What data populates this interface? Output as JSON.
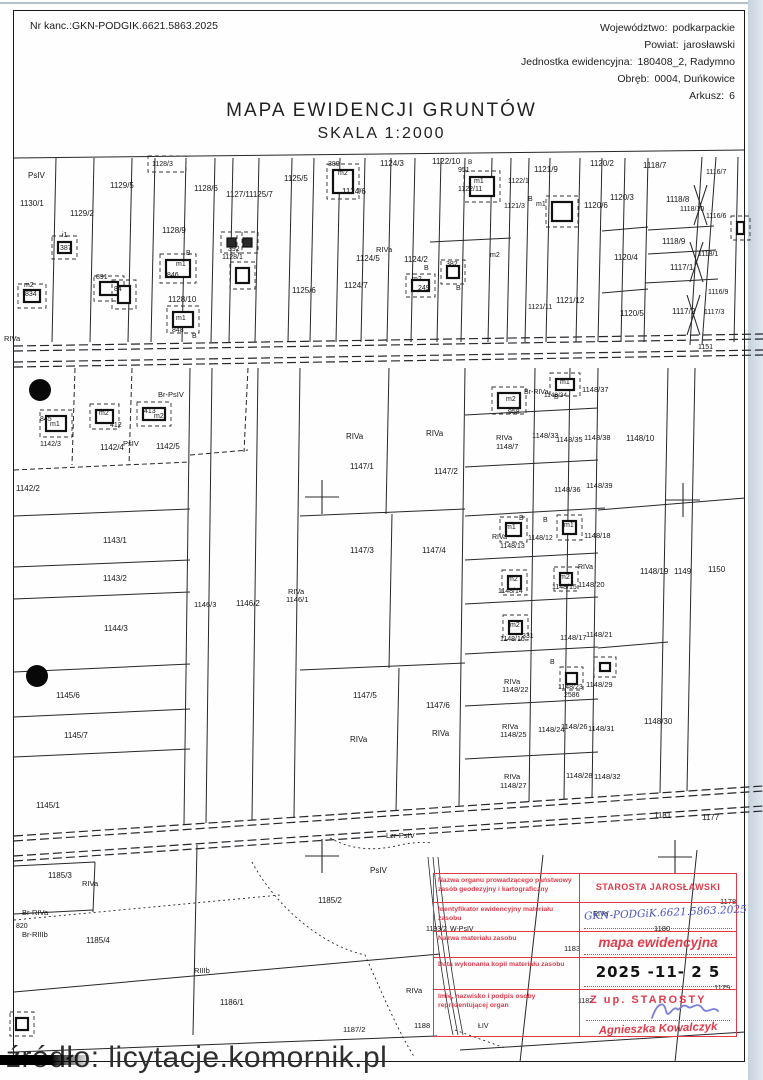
{
  "colors": {
    "stamp_red": "#e03a4a",
    "ink_blue": "#4a55c4",
    "map_black": "#1d1d1d",
    "scan_edge": "#c6d2dc"
  },
  "header": {
    "case_label": "Nr kanc.:",
    "case_number": "GKN-PODGIK.6621.5863.2025",
    "province_label": "Województwo:",
    "province": "podkarpackie",
    "county_label": "Powiat:",
    "county": "jarosławski",
    "unit_label": "Jednostka ewidencyjna:",
    "unit": "180408_2, Radymno",
    "district_label": "Obręb:",
    "district": "0004, Duńkowice",
    "sheet_label": "Arkusz:",
    "sheet": "6",
    "title": "MAPA EWIDENCJI GRUNTÓW",
    "scale": "SKALA 1:2000"
  },
  "stamp": {
    "field_labels": [
      "Nazwa organu prowadzącego państwowy zasób geodezyjny i kartograficzny",
      "Identyfikator ewidencyjny materiału zasobu",
      "Nazwa materiału zasobu",
      "Data wykonania kopii materiału zasobu",
      "Imię, nazwisko i podpis osoby reprezentującej organ"
    ],
    "authority": "STAROSTA JAROSŁAWSKI",
    "identifier_handwritten": "GKN-PODGiK.6621.5863.2025",
    "material_name": "mapa ewidencyjna",
    "copy_date": "2025 -11- 2 5",
    "signer_title": "Z up. STAROSTY",
    "signer_name": "Agnieszka Kowalczyk"
  },
  "watermark": {
    "text": "źródło: licytacje.komornik.pl"
  },
  "map": {
    "labels": [
      [
        "PsIV",
        28,
        178
      ],
      [
        "1130/1",
        20,
        206
      ],
      [
        "1129/5",
        110,
        188
      ],
      [
        "1129/2",
        70,
        216
      ],
      [
        "1128/3",
        152,
        166,
        7
      ],
      [
        "1128/6",
        194,
        191
      ],
      [
        "1127/1",
        226,
        197
      ],
      [
        "1125/7",
        249,
        197
      ],
      [
        "1125/5",
        284,
        181
      ],
      [
        "1128/9",
        162,
        233
      ],
      [
        "B",
        186,
        255,
        7
      ],
      [
        "m1",
        176,
        266,
        7
      ],
      [
        "846",
        167,
        277,
        7
      ],
      [
        "i1",
        62,
        237,
        7
      ],
      [
        "387",
        60,
        250,
        7
      ],
      [
        "891",
        96,
        279,
        7
      ],
      [
        "84",
        114,
        291,
        7
      ],
      [
        "m2",
        24,
        287,
        7
      ],
      [
        "834",
        25,
        296,
        7
      ],
      [
        "392",
        228,
        251,
        7
      ],
      [
        "1128/1",
        222,
        259,
        7
      ],
      [
        "1128/10",
        168,
        302
      ],
      [
        "m1",
        176,
        320,
        7
      ],
      [
        "848",
        172,
        332,
        7
      ],
      [
        "B",
        192,
        338,
        7
      ],
      [
        "RIVa",
        4,
        341,
        7.5
      ],
      [
        "389",
        328,
        166,
        7
      ],
      [
        "m2",
        338,
        175,
        7
      ],
      [
        "1124/3",
        380,
        166
      ],
      [
        "1124/6",
        342,
        194
      ],
      [
        "1122/10",
        432,
        164
      ],
      [
        "B",
        468,
        164,
        6.5
      ],
      [
        "951",
        458,
        172,
        7
      ],
      [
        "m1",
        474,
        183,
        7
      ],
      [
        "1122/11",
        458,
        191,
        7
      ],
      [
        "RIVa",
        376,
        252,
        7.5
      ],
      [
        "1124/5",
        356,
        261
      ],
      [
        "1124/2",
        404,
        262
      ],
      [
        "B",
        424,
        270,
        7
      ],
      [
        "m2",
        412,
        281,
        7
      ],
      [
        "249",
        418,
        290,
        7
      ],
      [
        "382",
        446,
        266,
        7
      ],
      [
        "B",
        456,
        290,
        7
      ],
      [
        "1125/6",
        292,
        293
      ],
      [
        "1124/7",
        344,
        288
      ],
      [
        "m2",
        490,
        257,
        7
      ],
      [
        "1121/9",
        534,
        172
      ],
      [
        "1122/1",
        508,
        183,
        7
      ],
      [
        "1121/3",
        504,
        208,
        7
      ],
      [
        "B",
        528,
        201,
        7
      ],
      [
        "m1",
        536,
        206,
        7
      ],
      [
        "1120/2",
        590,
        166
      ],
      [
        "1120/6",
        584,
        208
      ],
      [
        "1120/3",
        610,
        200
      ],
      [
        "1120/4",
        614,
        260
      ],
      [
        "1121/11",
        528,
        309,
        7
      ],
      [
        "1121/12",
        556,
        303
      ],
      [
        "1120/5",
        620,
        316
      ],
      [
        "1118/7",
        643,
        168
      ],
      [
        "1116/7",
        706,
        174,
        7
      ],
      [
        "1118/8",
        666,
        202
      ],
      [
        "1118/10",
        680,
        211,
        7
      ],
      [
        "1116/6",
        706,
        218,
        7
      ],
      [
        "1118/9",
        662,
        244
      ],
      [
        "1118/1",
        698,
        256,
        7
      ],
      [
        "1117/1",
        670,
        270
      ],
      [
        "1116/9",
        708,
        294,
        7
      ],
      [
        "1117/2",
        672,
        314
      ],
      [
        "1117/3",
        704,
        314,
        7
      ],
      [
        "1151",
        698,
        349,
        7
      ],
      [
        "845",
        40,
        421,
        7
      ],
      [
        "m1",
        50,
        426,
        7
      ],
      [
        "1142/3",
        40,
        446,
        7
      ],
      [
        "m2",
        99,
        415,
        7
      ],
      [
        "412",
        110,
        427,
        7
      ],
      [
        "413",
        144,
        413,
        7
      ],
      [
        "m2",
        154,
        418,
        7
      ],
      [
        "Br-PsIV",
        158,
        397,
        7.5
      ],
      [
        "PsIV",
        123,
        446,
        7.5
      ],
      [
        "1142/4",
        100,
        450
      ],
      [
        "1142/5",
        156,
        449
      ],
      [
        "1142/2",
        16,
        491
      ],
      [
        "1143/1",
        103,
        543
      ],
      [
        "1143/2",
        103,
        581
      ],
      [
        "1146/3",
        194,
        607,
        7.5
      ],
      [
        "1146/2",
        236,
        606
      ],
      [
        "RIVa",
        288,
        594,
        7.5
      ],
      [
        "1146/1",
        286,
        602,
        7.5
      ],
      [
        "1144/3",
        104,
        631
      ],
      [
        "1145/6",
        56,
        698
      ],
      [
        "1145/7",
        64,
        738
      ],
      [
        "1145/1",
        36,
        808
      ],
      [
        "RIVa",
        346,
        439
      ],
      [
        "1147/1",
        350,
        469
      ],
      [
        "RIVa",
        426,
        436
      ],
      [
        "1147/2",
        434,
        474
      ],
      [
        "m2",
        506,
        401,
        7
      ],
      [
        "958",
        508,
        414,
        7
      ],
      [
        "Br-RIVa",
        524,
        394,
        7
      ],
      [
        "RIVa",
        496,
        440,
        7.5
      ],
      [
        "1148/7",
        496,
        449,
        7.5
      ],
      [
        "m1",
        560,
        384,
        7
      ],
      [
        "B",
        554,
        399,
        7
      ],
      [
        "1148/34",
        544,
        397,
        6.5
      ],
      [
        "1148/37",
        582,
        392,
        7.5
      ],
      [
        "1148/33",
        532,
        438,
        7.5
      ],
      [
        "1148/35",
        556,
        442,
        7.5
      ],
      [
        "1148/38",
        584,
        440,
        7.5
      ],
      [
        "1148/10",
        626,
        441
      ],
      [
        "1148/36",
        554,
        492,
        7.5
      ],
      [
        "1148/39",
        586,
        488,
        7.5
      ],
      [
        "1147/3",
        350,
        553
      ],
      [
        "1147/4",
        422,
        553
      ],
      [
        "B",
        519,
        520,
        7
      ],
      [
        "m1",
        506,
        529,
        7
      ],
      [
        "RIVa",
        492,
        539,
        7
      ],
      [
        "1148/13",
        500,
        548,
        7
      ],
      [
        "B",
        543,
        522,
        7
      ],
      [
        "m1",
        564,
        527,
        7
      ],
      [
        "1148/12",
        528,
        540,
        7
      ],
      [
        "1148/18",
        584,
        538,
        7.5
      ],
      [
        "RIVa",
        578,
        569,
        7
      ],
      [
        "1148/20",
        578,
        587,
        7.5
      ],
      [
        "1148/19",
        640,
        574
      ],
      [
        "1149",
        674,
        574
      ],
      [
        "1150",
        708,
        572
      ],
      [
        "m2",
        508,
        581,
        7
      ],
      [
        "1148/14",
        498,
        593,
        7
      ],
      [
        "m2",
        560,
        579,
        7
      ],
      [
        "1148/15",
        552,
        589,
        7
      ],
      [
        "m2",
        510,
        627,
        7
      ],
      [
        "1148/16",
        500,
        641,
        7
      ],
      [
        "331",
        522,
        638,
        7
      ],
      [
        "1147/5",
        353,
        698
      ],
      [
        "1147/6",
        426,
        708
      ],
      [
        "RIVa",
        350,
        742
      ],
      [
        "RIVa",
        432,
        736
      ],
      [
        "1148/17",
        560,
        640,
        7.5
      ],
      [
        "1148/21",
        586,
        637,
        7.5
      ],
      [
        "B",
        550,
        664,
        7
      ],
      [
        "1148/23",
        558,
        689,
        7
      ],
      [
        "2586",
        564,
        697,
        7
      ],
      [
        "1148/29",
        586,
        687,
        7.5
      ],
      [
        "RIVa",
        504,
        684,
        7.5
      ],
      [
        "1148/22",
        502,
        692,
        7.5
      ],
      [
        "1148/24",
        538,
        732,
        7.5
      ],
      [
        "1148/26",
        561,
        729,
        7.5
      ],
      [
        "1148/31",
        588,
        731,
        7.5
      ],
      [
        "RIVa",
        502,
        729,
        7.5
      ],
      [
        "1148/25",
        500,
        737,
        7.5
      ],
      [
        "1148/30",
        644,
        724
      ],
      [
        "RIVa",
        504,
        779,
        7.5
      ],
      [
        "1148/27",
        500,
        788,
        7.5
      ],
      [
        "1148/28",
        566,
        778,
        7.5
      ],
      [
        "1148/32",
        594,
        779,
        7.5
      ],
      [
        "1181",
        654,
        818
      ],
      [
        "1177",
        702,
        820
      ],
      [
        "1185/3",
        48,
        878
      ],
      [
        "RIVa",
        82,
        886,
        7.5
      ],
      [
        "Br-RIVa",
        22,
        915,
        7.5
      ],
      [
        "820",
        16,
        928,
        7
      ],
      [
        "Br-RIIIb",
        22,
        937,
        7.5
      ],
      [
        "1185/4",
        86,
        943
      ],
      [
        "Lzr-PsIV",
        386,
        838,
        7.5
      ],
      [
        "PsIV",
        370,
        873
      ],
      [
        "1185/2",
        318,
        903
      ],
      [
        "RIIIb",
        194,
        973,
        7.5
      ],
      [
        "1186/1",
        220,
        1005
      ],
      [
        "1187/2",
        343,
        1032,
        7.5
      ],
      [
        "1188",
        414,
        1028,
        7.5
      ],
      [
        "ŁIV",
        478,
        1028,
        7
      ],
      [
        "1193/2",
        426,
        931,
        7
      ],
      [
        "W-PsIV",
        450,
        931,
        7
      ],
      [
        "RIVa",
        406,
        993,
        7.5
      ],
      [
        "RIVa",
        593,
        916,
        7
      ],
      [
        "1180",
        654,
        931,
        7.5
      ],
      [
        "1183",
        564,
        951,
        7.5
      ],
      [
        "1182",
        578,
        1003,
        7
      ],
      [
        "1179",
        714,
        990,
        7.5
      ],
      [
        "1178",
        720,
        904,
        7.5
      ]
    ]
  }
}
